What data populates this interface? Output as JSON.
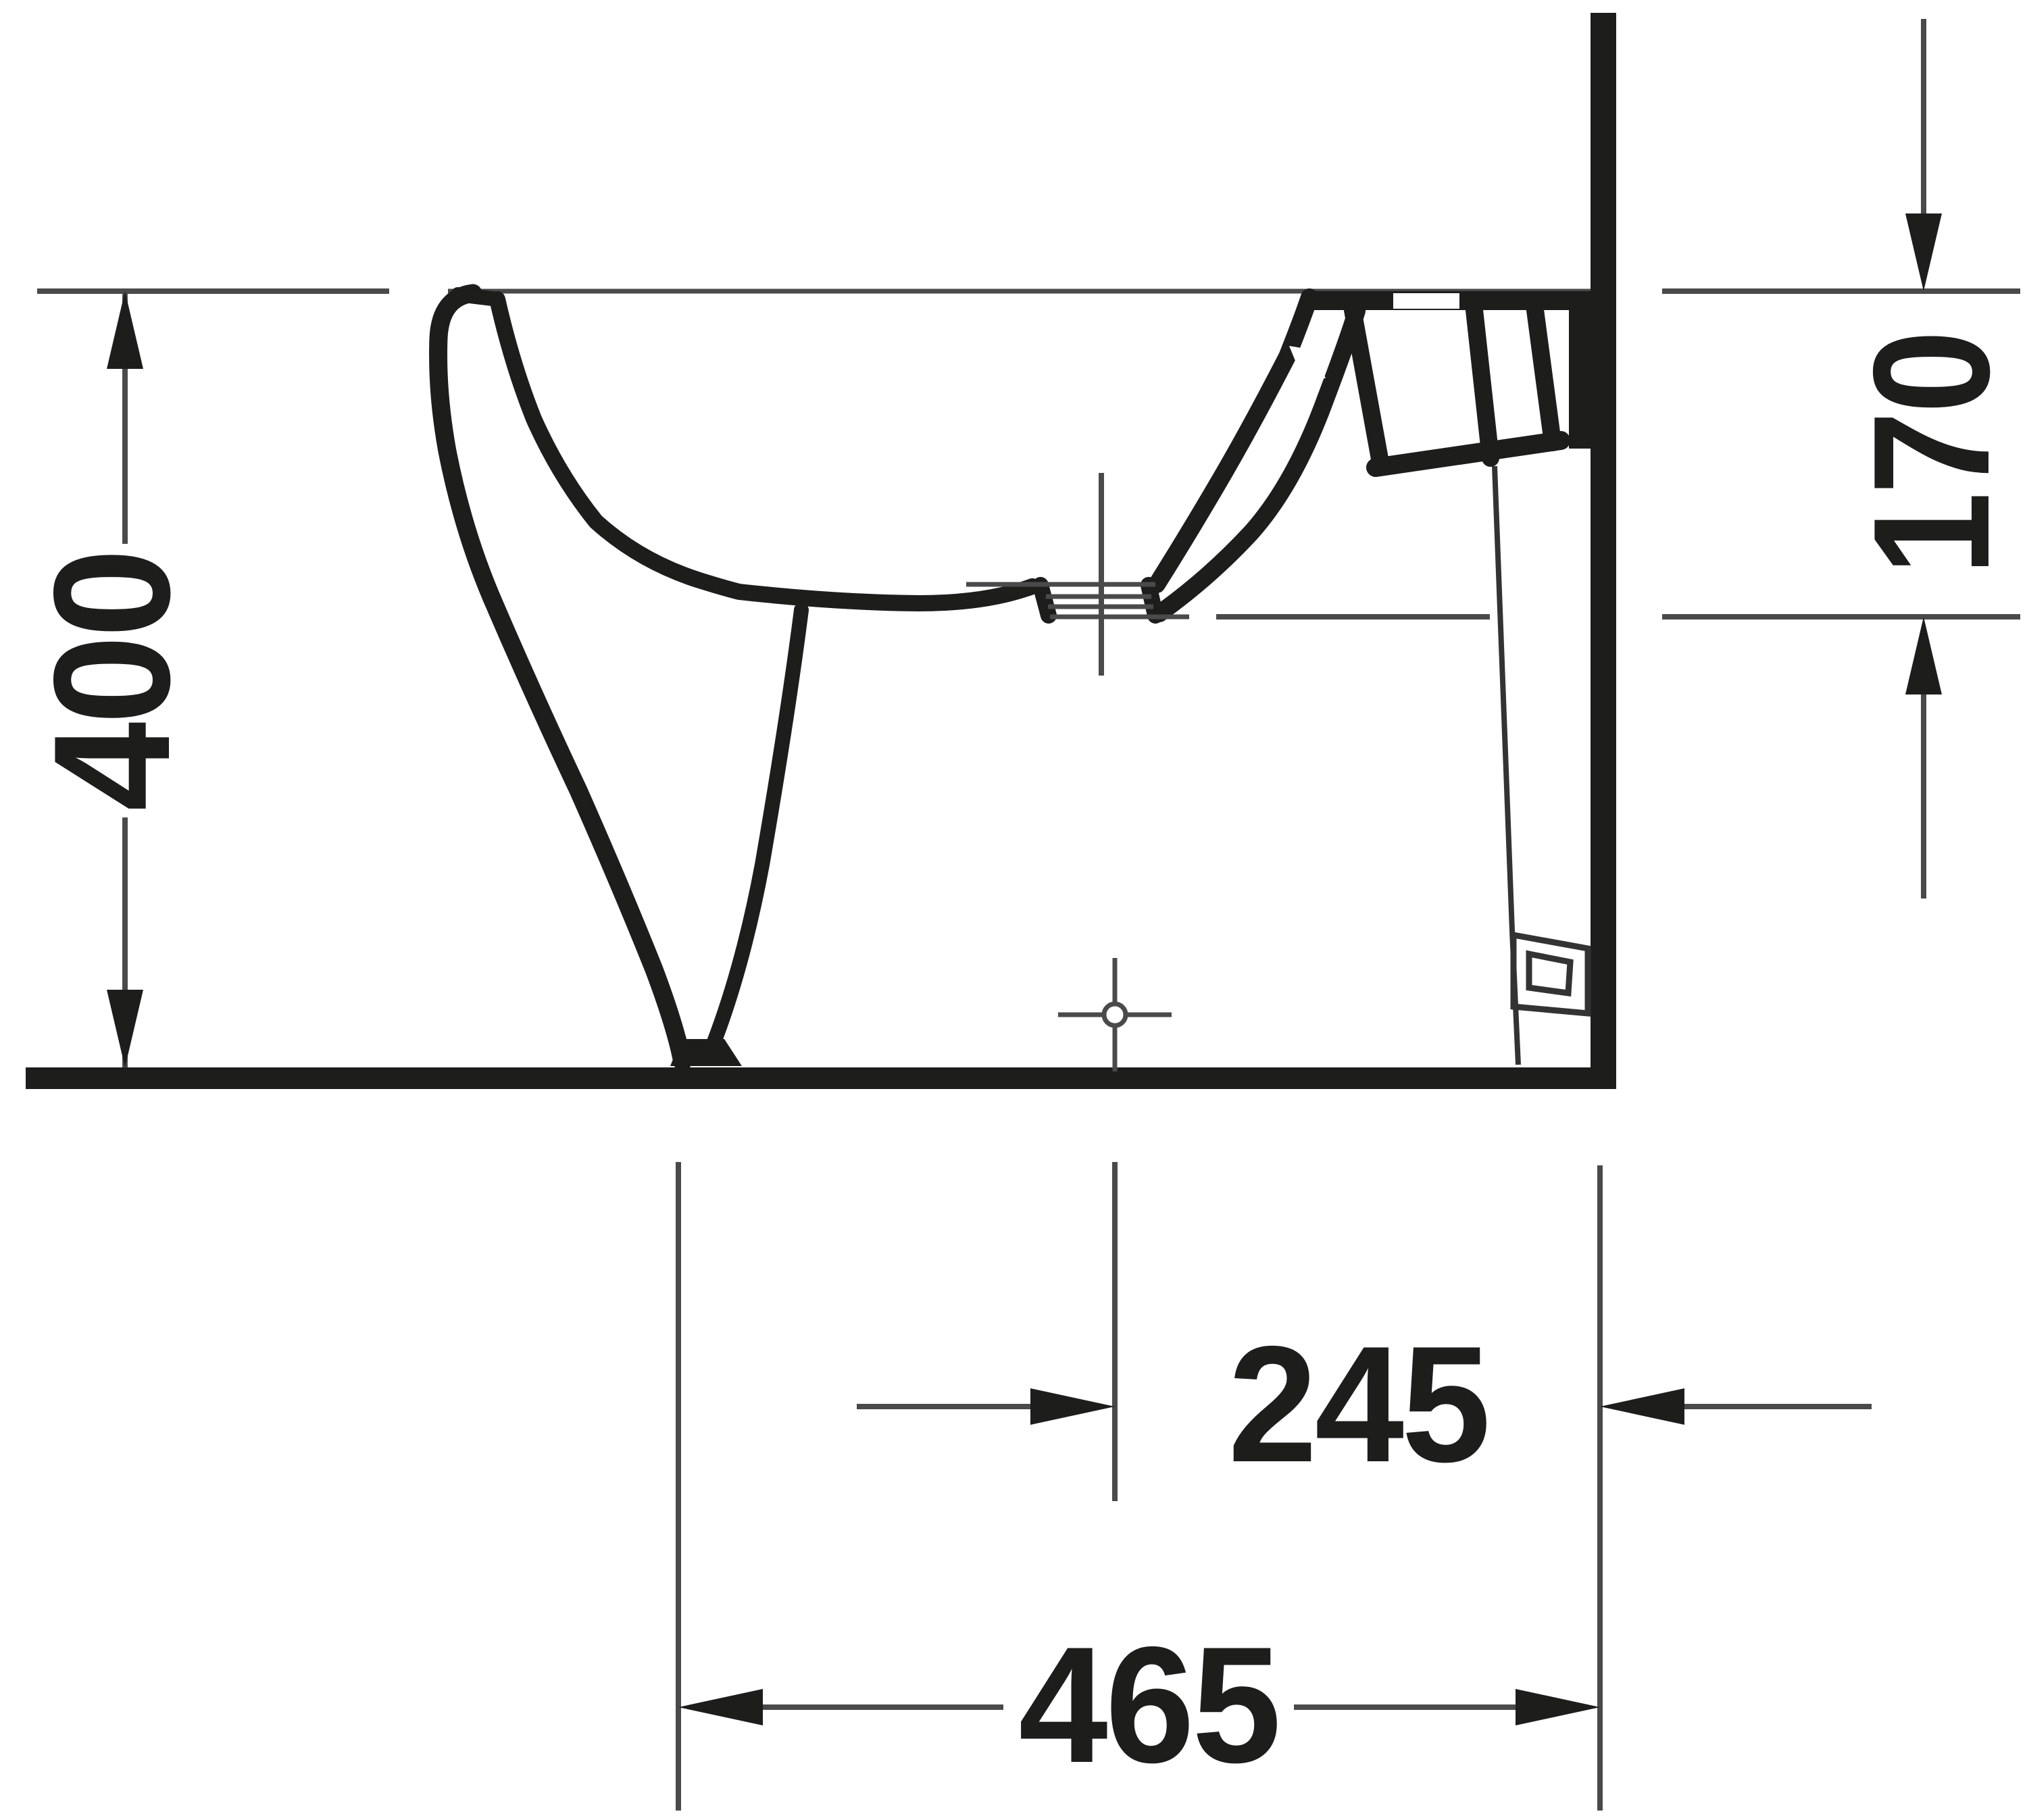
{
  "drawing": {
    "subject": "bidet-side-elevation-technical-drawing",
    "background_color": "#ffffff",
    "outline_color": "#1d1d1b",
    "thin_line_color": "#4a4a4a",
    "dimensions": {
      "overall_height": {
        "value": "400",
        "orientation": "vertical-rotated"
      },
      "rim_to_spray_level": {
        "value": "170",
        "orientation": "vertical-rotated"
      },
      "outlet_center_to_wall": {
        "value": "245",
        "orientation": "horizontal"
      },
      "overall_depth": {
        "value": "465",
        "orientation": "horizontal"
      }
    }
  }
}
